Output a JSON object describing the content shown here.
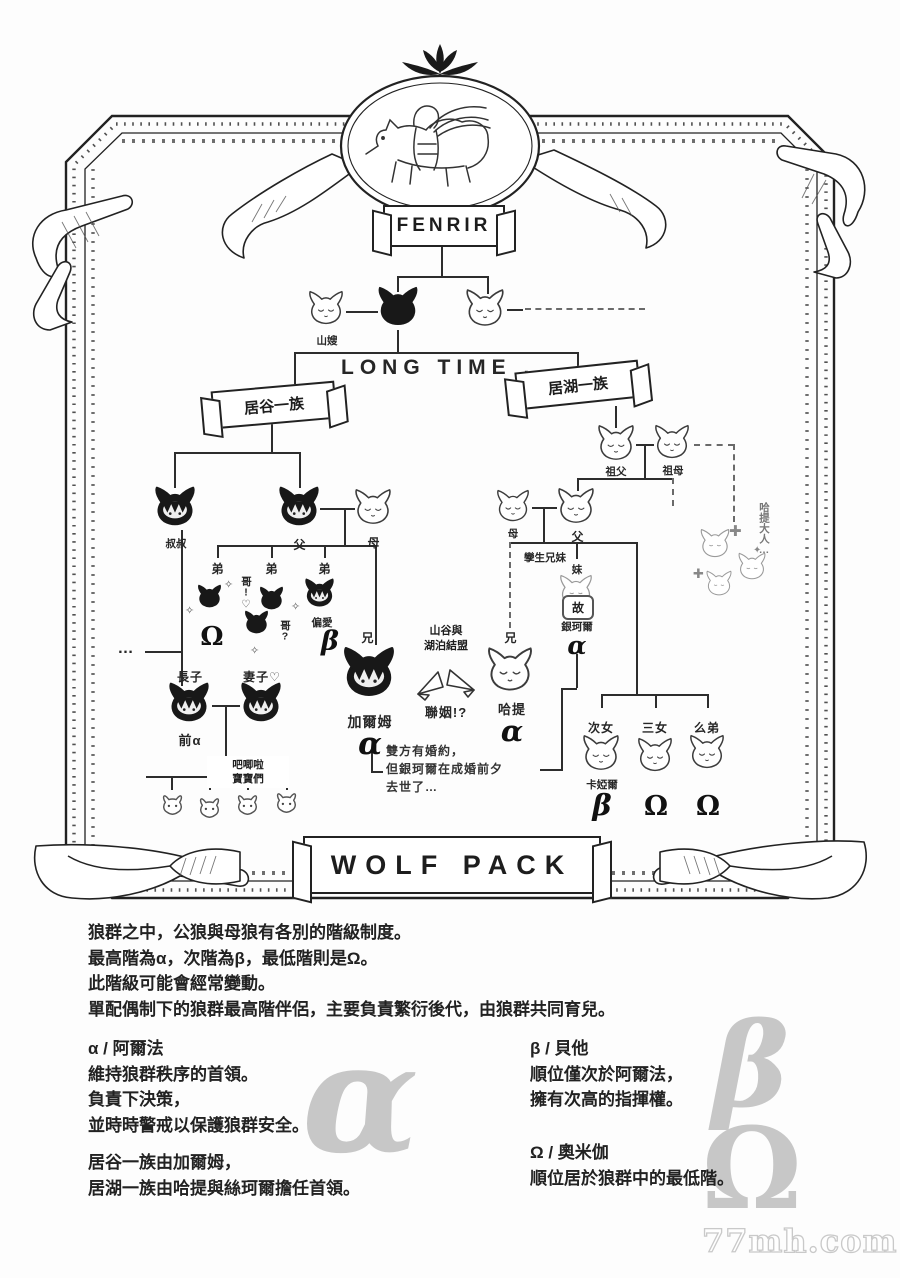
{
  "crest": {
    "title": "FENRIR"
  },
  "watermark": "77mh.com",
  "tree": {
    "long_time": "LONG TIME ...",
    "valley_banner": "居谷一族",
    "lake_banner": "居湖一族",
    "wolf_pack_banner": "WOLF PACK",
    "top": {
      "yamauba": "山嫂"
    },
    "valley": {
      "uncle": "叔叔",
      "father": "父",
      "mother": "母",
      "bro1": "弟",
      "bro2": "弟",
      "bro3": "弟",
      "omega1": "Ω",
      "beta1": "β",
      "bro_call1": "哥!♡",
      "bro_call2": "哥?",
      "favorite": "偏愛",
      "elder_bro": "兄",
      "garm": "加爾姆",
      "garm_rank": "α",
      "eldest_son": "長子",
      "former_alpha": "前α",
      "wife": "妻子♡",
      "babies_line1": "吧唧啦",
      "babies_line2": "寶寶們",
      "ellipsis": "…"
    },
    "middle": {
      "alliance_line1": "山谷與",
      "alliance_line2": "湖泊結盟",
      "marriage": "聯姻!?",
      "note_line1": "雙方有婚約，",
      "note_line2": "但銀珂爾在成婚前夕",
      "note_line3": "去世了…"
    },
    "lake": {
      "grandfather": "祖父",
      "grandmother": "祖母",
      "mother": "母",
      "father": "父",
      "twins": "孿生兄妹",
      "sister": "妹",
      "deceased": "故",
      "ginkor": "銀珂爾",
      "ginkor_rank": "α",
      "elder_bro": "兄",
      "hati": "哈提",
      "hati_rank": "α",
      "second_daughter": "次女",
      "third_daughter": "三女",
      "youngest_brother": "么弟",
      "kayar": "卡婭爾",
      "rank_second": "β",
      "rank_third": "Ω",
      "rank_youngest": "Ω",
      "fans_text": "哈提大人…"
    }
  },
  "bottom": {
    "intro": [
      "狼群之中，公狼與母狼有各別的階級制度。",
      "最高階為α，次階為β，最低階則是Ω。",
      "此階級可能會經常變動。",
      "單配偶制下的狼群最高階伴侶，主要負責繁衍後代，由狼群共同育兒。"
    ],
    "alpha_title": "α / 阿爾法",
    "alpha_lines": [
      "維持狼群秩序的首領。",
      "負責下決策，",
      "並時時警戒以保護狼群安全。"
    ],
    "leaders_lines": [
      "居谷一族由加爾姆，",
      "居湖一族由哈提與絲珂爾擔任首領。"
    ],
    "beta_title": "β / 貝他",
    "beta_lines": [
      "順位僅次於阿爾法，",
      "擁有次高的指揮權。"
    ],
    "omega_title": "Ω / 奧米伽",
    "omega_lines": [
      "順位居於狼群中的最低階。"
    ],
    "big_alpha": "α",
    "big_beta": "β",
    "big_omega": "Ω"
  }
}
